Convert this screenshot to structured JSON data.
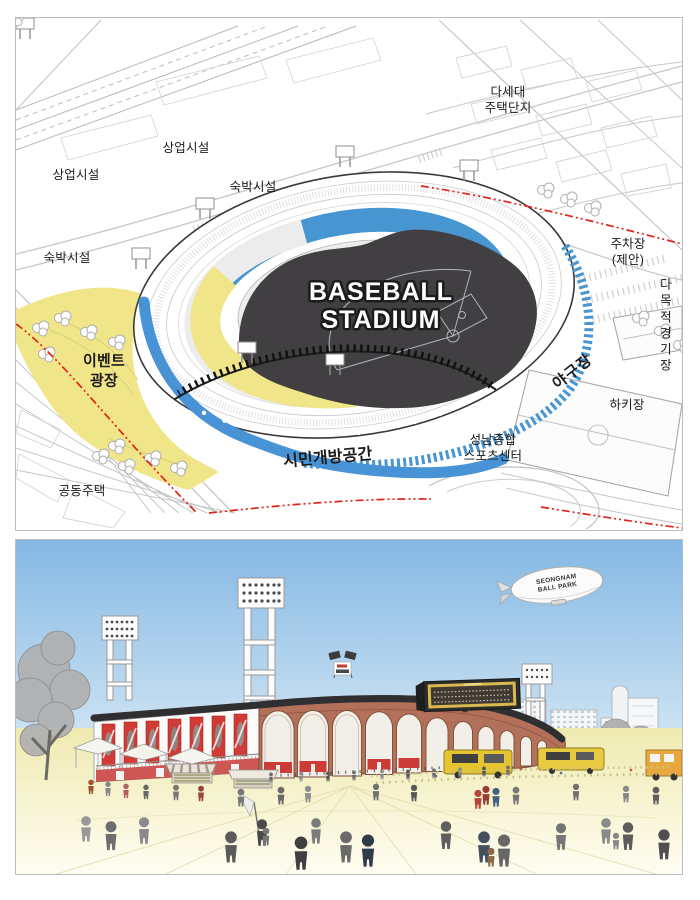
{
  "map": {
    "labels": {
      "multi_family_housing": "다세대\n주택단지",
      "commercial_top": "상업시설",
      "commercial_left": "상업시설",
      "lodging_top": "숙박시설",
      "lodging_left": "숙박시설",
      "parking_proposed": "주차장\n(제안)",
      "multipurpose_field": "다목적\n경기장",
      "hockey_field": "하키장",
      "baseball_field_road": "야구장",
      "sports_center": "성남종합\n스포츠센터",
      "citizen_open_space": "시민개방공간",
      "event_plaza": "이벤트\n광장",
      "apartment_housing": "공동주택",
      "stadium_title": "BASEBALL\nSTADIUM"
    },
    "colors": {
      "event_plaza_fill": "#f0e588",
      "seating_band": "#4796d2",
      "open_space_band": "#4793d6",
      "stadium_roof": "#413f42",
      "boundary_line": "#e2231a"
    }
  },
  "render": {
    "blimp_text": "SEONGNAM\nBALL PARK",
    "colors": {
      "sky": "#84b8e4",
      "brick": "#b3715a",
      "banner_red": "#d23a35",
      "scoreboard_yellow": "#d9b94e",
      "plaza_ground": "#efeab0"
    }
  }
}
